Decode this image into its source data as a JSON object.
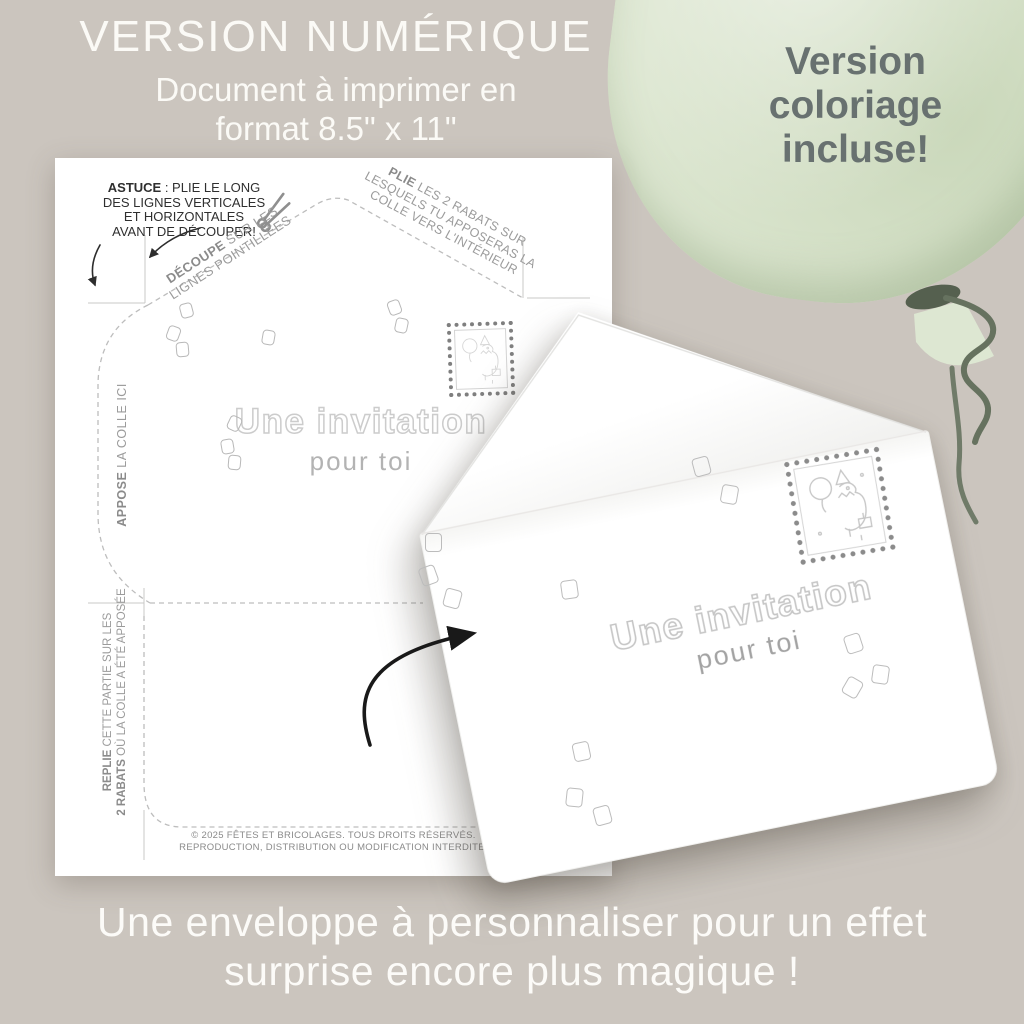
{
  "header": {
    "title": "VERSION NUMÉRIQUE",
    "subtitle_lines": [
      "Document à imprimer en",
      "format 8.5\" x 11\""
    ]
  },
  "balloon": {
    "label_lines": [
      "Version",
      "coloriage",
      "incluse!"
    ],
    "fill_color": "#dce6d0",
    "text_color": "#687170"
  },
  "template_page": {
    "tip": {
      "bold": "ASTUCE",
      "line1_rest": " : PLIE LE LONG",
      "line2": "DES LIGNES VERTICALES",
      "line3": "ET HORIZONTALES",
      "line4": "AVANT DE DÉCOUPER!"
    },
    "cut_note": {
      "bold": "DÉCOUPE",
      "line1_rest": " SUR LES",
      "line2": "LIGNES POINTILLÉES"
    },
    "fold_note": {
      "bold": "PLIE",
      "line1_rest": " LES 2 RABATS SUR",
      "line2": "LESQUELS TU APPOSERAS LA",
      "line3": "COLLE VERS L'INTÉRIEUR"
    },
    "glue_note": {
      "bold": "APPOSE",
      "rest": " LA COLLE ICI"
    },
    "refold_note": {
      "line1_bold": "REPLIE",
      "line1_rest": " CETTE PARTIE SUR LES",
      "line2_bold": "2 RABATS",
      "line2_rest": " OÙ LA COLLE A ÉTÉ APPOSÉE"
    },
    "invitation": {
      "title": "Une invitation",
      "subtitle": "pour toi"
    },
    "footer_lines": [
      "© 2025 FÊTES ET BRICOLAGES. TOUS DROITS RÉSERVÉS.",
      "REPRODUCTION, DISTRIBUTION OU MODIFICATION INTERDITE."
    ]
  },
  "envelope": {
    "invitation": {
      "title": "Une invitation",
      "subtitle": "pour toi"
    }
  },
  "caption": {
    "lines": [
      "Une enveloppe à personnaliser pour un effet",
      "surprise encore plus magique !"
    ]
  },
  "colors": {
    "background": "#cbc5be",
    "paper": "#ffffff",
    "balloon_green": "#dce6d0",
    "balloon_string": "#66725f",
    "gray_text": "#9b9b9b",
    "dark_text": "#2f2f2f",
    "outline_letters": "#cccccc"
  }
}
